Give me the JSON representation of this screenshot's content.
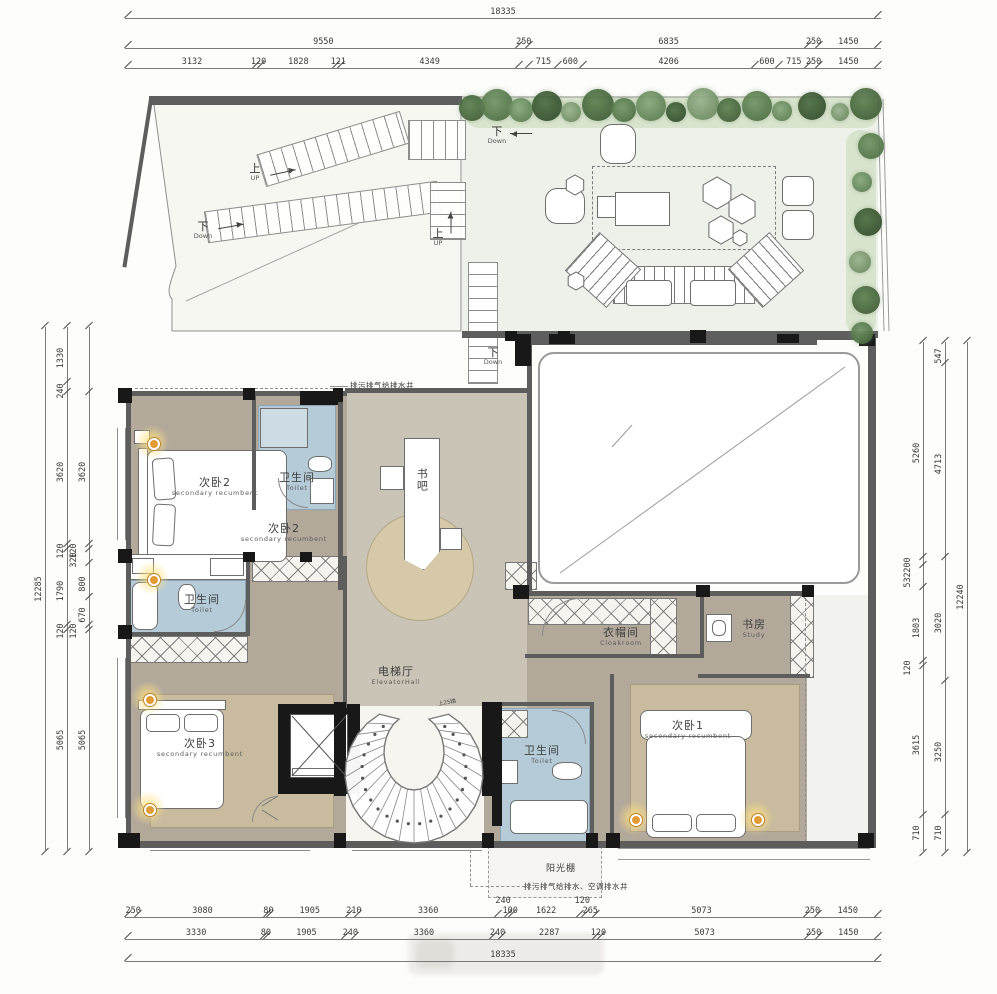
{
  "annotations": {
    "top_well": "排污排气给排水井",
    "bottom_well": "排污排气给排水、空调排水井",
    "spiral_steps": "上25踏"
  },
  "stairs": {
    "up_zh": "上",
    "up_en": "UP",
    "down_zh": "下",
    "down_en": "Down"
  },
  "rooms": {
    "bedroom2_bed": {
      "zh": "次卧2",
      "en": "secondary recumbent"
    },
    "bedroom2": {
      "zh": "次卧2",
      "en": "secondary recumbent"
    },
    "toilet_top": {
      "zh": "卫生间",
      "en": "Toilet"
    },
    "toilet_left": {
      "zh": "卫生间",
      "en": "Toilet"
    },
    "bedroom3": {
      "zh": "次卧3",
      "en": "secondary recumbent"
    },
    "elevator_hall": {
      "zh": "电梯厅",
      "en": "ElevatorHall"
    },
    "book_bar": {
      "zh": "书吧"
    },
    "cloakroom": {
      "zh": "衣帽间",
      "en": "Cloakroom"
    },
    "study": {
      "zh": "书房",
      "en": "Study"
    },
    "bedroom1": {
      "zh": "次卧1",
      "en": "secondary recumbent"
    },
    "toilet_bottom": {
      "zh": "卫生间",
      "en": "Toilet"
    },
    "sunroom": {
      "zh": "阳光棚"
    }
  },
  "dims": {
    "top": {
      "r1": [
        {
          "v": "18335",
          "w": 18335
        }
      ],
      "r2": [
        "9550",
        "250",
        "6835",
        "250",
        "1450"
      ],
      "r3": [
        "3132",
        "120",
        "1828",
        "121",
        "4349",
        {
          "v": "",
          "w": 250
        },
        "715",
        "600",
        "4206",
        "600",
        "715",
        "250",
        "1450"
      ]
    },
    "bottom": {
      "r1": [
        "250",
        "3080",
        "80",
        "1905",
        "210",
        "3360",
        {
          "v": "240",
          "w": 240,
          "up": true
        },
        "100",
        "1622",
        {
          "v": "120",
          "w": 120,
          "up": true
        },
        "265",
        "5073",
        "250",
        "1450"
      ],
      "r2": [
        "3330",
        "80",
        "1905",
        "240",
        "3360",
        "240",
        "2287",
        "120",
        "5073",
        "250",
        "1450"
      ],
      "r3": [
        {
          "v": "18335",
          "w": 18335
        }
      ]
    },
    "left": {
      "outer": [
        {
          "v": "12285",
          "w": 12285
        }
      ],
      "mid": [
        "1330",
        "240",
        "3620",
        "120",
        "1790",
        "120",
        "5065"
      ],
      "inner": [
        {
          "v": "",
          "w": 1570
        },
        "3620",
        {
          "v": "120",
          "w": 120,
          "up": true
        },
        {
          "v": "320",
          "w": 320,
          "up": true
        },
        "800",
        "670",
        {
          "v": "120",
          "w": 120,
          "up": true
        },
        "5065"
      ]
    },
    "right": {
      "inner": [
        "5260",
        {
          "v": "200",
          "w": 200,
          "up": true
        },
        {
          "v": "532",
          "w": 532,
          "up": true
        },
        "1803",
        {
          "v": "120",
          "w": 120,
          "up": true
        },
        "3615",
        "710"
      ],
      "mid": [
        "547",
        "4713",
        "3020",
        "3250",
        "710"
      ],
      "outer": [
        {
          "v": "12240",
          "w": 12240
        }
      ]
    }
  }
}
